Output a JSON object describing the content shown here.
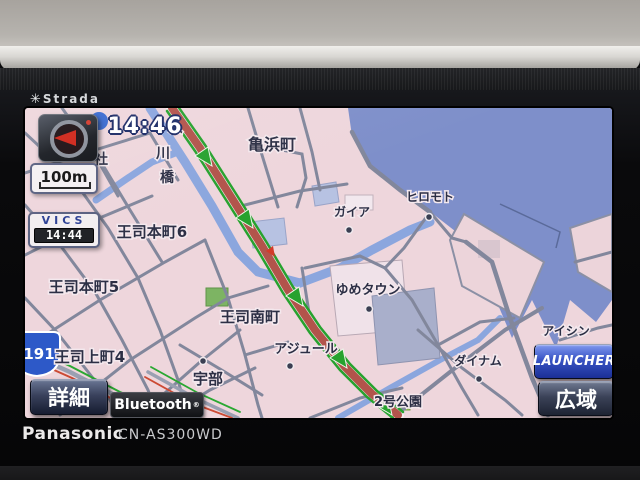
{
  "device": {
    "brand_mark": "✳",
    "brand": "Strada",
    "maker": "Panasonic",
    "model": "CN-AS300WD"
  },
  "hud": {
    "clock": "14:46",
    "scale": "100m",
    "vics_label": "VICS",
    "vics_time": "14:44",
    "detail_button": "詳細",
    "wide_button": "広域",
    "launcher_button": "LAUNCHER",
    "bluetooth_badge": "Bluetooth",
    "bluetooth_reg": "®",
    "compass_icon": "heading-up-red-arrow"
  },
  "map": {
    "route_shield": "191",
    "labels": [
      {
        "text": "亀浜町"
      },
      {
        "text": "社"
      },
      {
        "text": "川"
      },
      {
        "text": "橋"
      },
      {
        "text": "入"
      },
      {
        "text": "王司本町6"
      },
      {
        "text": "王司本町5"
      },
      {
        "text": "王司南町"
      },
      {
        "text": "ゆめタウン"
      },
      {
        "text": "アジュール"
      },
      {
        "text": "ヒロモト"
      },
      {
        "text": "ガイア"
      },
      {
        "text": "王司上町4"
      },
      {
        "text": "宇部"
      },
      {
        "text": "アイシン"
      },
      {
        "text": "ダイナム"
      },
      {
        "text": "2号公園"
      }
    ],
    "colors": {
      "land": "#eed6dc",
      "water": "#7e8fca",
      "river": "#8ba6de",
      "street": "#82879c",
      "main_road": "#b2544b",
      "route_green": "#27a22e",
      "vics_red": "#cc4a34",
      "building_blue": "#b7c2e2",
      "building_gray": "#a9afcb",
      "park_green": "#7db463",
      "shield_blue": "#2d59c8"
    }
  }
}
